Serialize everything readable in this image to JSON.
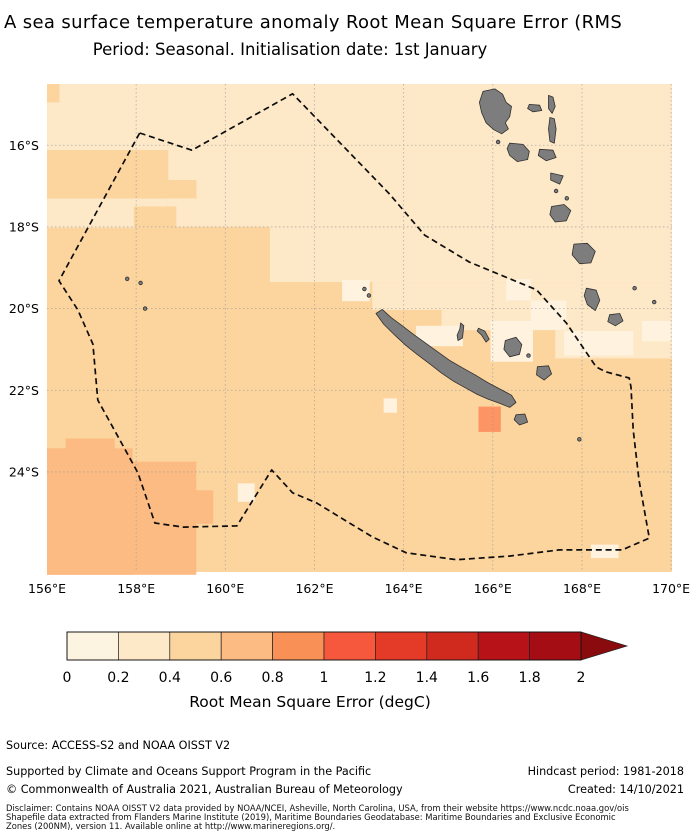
{
  "title": {
    "line1": "A sea surface temperature anomaly Root Mean Square Error (RMS",
    "line2": "Period: Seasonal. Initialisation date: 1st January"
  },
  "footer": {
    "source_line": "Source: ACCESS-S2 and NOAA OISST V2",
    "supported_line": "Supported by Climate and Oceans Support Program in the Pacific",
    "hindcast_line": "Hindcast period: 1981-2018",
    "copyright_line": "© Commonwealth of Australia 2021, Australian Bureau of Meteorology",
    "created_line": "Created: 14/10/2021",
    "disclaimer_lines": [
      "Disclaimer: Contains NOAA OISST V2 data provided by NOAA/NCEI, Asheville, North Carolina, USA, from their website https://www.ncdc.noaa.gov/ois",
      "Shapefile data extracted from Flanders Marine Institute (2019), Maritime Boundaries Geodatabase: Maritime Boundaries and Exclusive Economic",
      "Zones (200NM), version 11. Available online at http://www.marineregions.org/."
    ]
  },
  "chart_data": {
    "type": "heatmap",
    "title": "A sea surface temperature anomaly Root Mean Square Error (RMS",
    "subtitle": "Period: Seasonal. Initialisation date: 1st January",
    "region": "New Caledonia EEZ and surrounding Coral Sea / Vanuatu",
    "lon_range": [
      156.0,
      170.02
    ],
    "lat_range_south": [
      14.5,
      26.45
    ],
    "grid_lons": [
      158,
      160,
      162,
      164,
      166,
      168,
      170
    ],
    "grid_lats": [
      16,
      18,
      20,
      22,
      24
    ],
    "lon_tick_labels": [
      "156°E",
      "158°E",
      "160°E",
      "162°E",
      "164°E",
      "166°E",
      "168°E",
      "170°E"
    ],
    "lat_tick_labels": [
      "16°S",
      "18°S",
      "20°S",
      "22°S",
      "24°S"
    ],
    "colorbar": {
      "label": "Root Mean Square Error (degC)",
      "tick_labels": [
        "0",
        "0.2",
        "0.4",
        "0.6",
        "0.8",
        "1",
        "1.2",
        "1.4",
        "1.6",
        "1.8",
        "2"
      ],
      "range": [
        0,
        2
      ],
      "extend": "max",
      "segment_colors": [
        "#fdf3e1",
        "#fde8c8",
        "#fcd49e",
        "#fbbb83",
        "#f99157",
        "#f6583e",
        "#e43a28",
        "#cf2a1d",
        "#b71217",
        "#a30d13"
      ],
      "arrow_color": "#8a0b0e"
    },
    "band_values_degC": [
      "0-0.2",
      "0.2-0.4",
      "0.4-0.6",
      "0.6-0.8",
      "0.8-1.0"
    ],
    "band_colors": [
      "#fff3e0",
      "#fde8c8",
      "#fcd49e",
      "#fbbb83",
      "#fc9464"
    ],
    "base_band": 2,
    "patches": [
      {
        "lon": 156.0,
        "lat": 14.5,
        "w": 14.02,
        "h": 1.62,
        "band": 1
      },
      {
        "lon": 158.7,
        "lat": 16.12,
        "w": 11.32,
        "h": 1.88,
        "band": 1
      },
      {
        "lon": 156.0,
        "lat": 17.3,
        "w": 2.7,
        "h": 0.72,
        "band": 1
      },
      {
        "lon": 161.0,
        "lat": 18.0,
        "w": 9.02,
        "h": 1.35,
        "band": 1
      },
      {
        "lon": 163.3,
        "lat": 19.35,
        "w": 6.72,
        "h": 0.68,
        "band": 1
      },
      {
        "lon": 164.85,
        "lat": 20.03,
        "w": 5.17,
        "h": 0.5,
        "band": 1
      },
      {
        "lon": 167.4,
        "lat": 20.5,
        "w": 2.62,
        "h": 0.72,
        "band": 1
      },
      {
        "lon": 156.0,
        "lat": 14.5,
        "w": 0.28,
        "h": 0.45,
        "band": 2
      },
      {
        "lon": 156.0,
        "lat": 16.12,
        "w": 2.72,
        "h": 1.18,
        "band": 2
      },
      {
        "lon": 158.7,
        "lat": 16.85,
        "w": 0.65,
        "h": 0.45,
        "band": 2
      },
      {
        "lon": 157.95,
        "lat": 17.5,
        "w": 0.95,
        "h": 0.52,
        "band": 2
      },
      {
        "lon": 162.62,
        "lat": 19.3,
        "w": 0.62,
        "h": 0.52,
        "band": 0
      },
      {
        "lon": 166.3,
        "lat": 19.28,
        "w": 0.55,
        "h": 0.52,
        "band": 0
      },
      {
        "lon": 164.28,
        "lat": 20.42,
        "w": 1.05,
        "h": 0.5,
        "band": 0
      },
      {
        "lon": 165.95,
        "lat": 20.3,
        "w": 0.95,
        "h": 1.0,
        "band": 0
      },
      {
        "lon": 166.85,
        "lat": 19.8,
        "w": 0.8,
        "h": 0.72,
        "band": 0
      },
      {
        "lon": 167.6,
        "lat": 20.55,
        "w": 1.55,
        "h": 0.6,
        "band": 0
      },
      {
        "lon": 169.35,
        "lat": 20.3,
        "w": 0.65,
        "h": 0.5,
        "band": 0
      },
      {
        "lon": 168.2,
        "lat": 25.78,
        "w": 0.62,
        "h": 0.33,
        "band": 0
      },
      {
        "lon": 160.28,
        "lat": 24.28,
        "w": 0.38,
        "h": 0.45,
        "band": 0
      },
      {
        "lon": 163.55,
        "lat": 22.2,
        "w": 0.3,
        "h": 0.35,
        "band": 0
      },
      {
        "lon": 156.0,
        "lat": 23.42,
        "w": 1.92,
        "h": 3.1,
        "band": 3
      },
      {
        "lon": 157.9,
        "lat": 23.75,
        "w": 1.45,
        "h": 2.77,
        "band": 3
      },
      {
        "lon": 159.33,
        "lat": 24.45,
        "w": 0.4,
        "h": 0.82,
        "band": 3
      },
      {
        "lon": 156.42,
        "lat": 23.18,
        "w": 1.1,
        "h": 0.3,
        "band": 3
      },
      {
        "lon": 165.68,
        "lat": 22.4,
        "w": 0.5,
        "h": 0.62,
        "band": 4
      }
    ],
    "eez_boundary": [
      [
        158.08,
        15.7
      ],
      [
        159.25,
        16.12
      ],
      [
        161.51,
        14.74
      ],
      [
        163.68,
        17.19
      ],
      [
        164.47,
        18.2
      ],
      [
        165.47,
        18.86
      ],
      [
        166.98,
        19.54
      ],
      [
        167.65,
        20.35
      ],
      [
        168.32,
        21.43
      ],
      [
        168.54,
        21.55
      ],
      [
        169.06,
        21.7
      ],
      [
        169.1,
        21.92
      ],
      [
        169.15,
        22.97
      ],
      [
        169.28,
        24.2
      ],
      [
        169.51,
        25.62
      ],
      [
        168.9,
        25.91
      ],
      [
        167.49,
        25.91
      ],
      [
        166.37,
        26.06
      ],
      [
        165.18,
        26.15
      ],
      [
        164.06,
        25.98
      ],
      [
        163.3,
        25.59
      ],
      [
        162.56,
        25.1
      ],
      [
        162.05,
        24.76
      ],
      [
        161.51,
        24.51
      ],
      [
        161.04,
        23.95
      ],
      [
        160.26,
        25.32
      ],
      [
        159.05,
        25.35
      ],
      [
        158.42,
        25.25
      ],
      [
        158.04,
        24.02
      ],
      [
        157.57,
        23.09
      ],
      [
        157.14,
        22.24
      ],
      [
        157.03,
        20.87
      ],
      [
        156.69,
        20.03
      ],
      [
        156.27,
        19.32
      ]
    ],
    "land_color": "#7d7d7d",
    "land_edge_color": "#2f2f2f",
    "islands": {
      "grande-terre": [
        [
          163.38,
          20.12
        ],
        [
          163.52,
          20.02
        ],
        [
          163.72,
          20.22
        ],
        [
          163.97,
          20.42
        ],
        [
          164.22,
          20.63
        ],
        [
          164.5,
          20.85
        ],
        [
          164.78,
          21.07
        ],
        [
          165.05,
          21.28
        ],
        [
          165.32,
          21.45
        ],
        [
          165.6,
          21.62
        ],
        [
          165.9,
          21.82
        ],
        [
          166.18,
          21.98
        ],
        [
          166.42,
          22.12
        ],
        [
          166.52,
          22.3
        ],
        [
          166.38,
          22.42
        ],
        [
          166.15,
          22.32
        ],
        [
          165.9,
          22.22
        ],
        [
          165.65,
          22.1
        ],
        [
          165.4,
          21.95
        ],
        [
          165.12,
          21.78
        ],
        [
          164.85,
          21.58
        ],
        [
          164.58,
          21.35
        ],
        [
          164.3,
          21.12
        ],
        [
          164.05,
          20.9
        ],
        [
          163.8,
          20.65
        ],
        [
          163.55,
          20.38
        ]
      ],
      "espiritu-santo": [
        [
          165.78,
          14.68
        ],
        [
          166.05,
          14.62
        ],
        [
          166.22,
          14.75
        ],
        [
          166.3,
          14.95
        ],
        [
          166.42,
          15.05
        ],
        [
          166.38,
          15.3
        ],
        [
          166.28,
          15.45
        ],
        [
          166.35,
          15.6
        ],
        [
          166.2,
          15.72
        ],
        [
          166.02,
          15.62
        ],
        [
          165.85,
          15.45
        ],
        [
          165.75,
          15.2
        ],
        [
          165.7,
          14.95
        ]
      ],
      "malakula": [
        [
          166.38,
          15.95
        ],
        [
          166.68,
          15.98
        ],
        [
          166.82,
          16.15
        ],
        [
          166.78,
          16.35
        ],
        [
          166.55,
          16.4
        ],
        [
          166.38,
          16.25
        ],
        [
          166.32,
          16.08
        ]
      ],
      "maewo": [
        [
          167.25,
          14.78
        ],
        [
          167.35,
          14.82
        ],
        [
          167.4,
          15.05
        ],
        [
          167.33,
          15.22
        ],
        [
          167.25,
          15.1
        ]
      ],
      "pentecost": [
        [
          167.28,
          15.32
        ],
        [
          167.38,
          15.35
        ],
        [
          167.42,
          15.6
        ],
        [
          167.38,
          15.95
        ],
        [
          167.28,
          15.9
        ],
        [
          167.25,
          15.6
        ]
      ],
      "ambae": [
        [
          166.82,
          15.0
        ],
        [
          167.05,
          15.02
        ],
        [
          167.1,
          15.15
        ],
        [
          166.9,
          15.18
        ],
        [
          166.78,
          15.1
        ]
      ],
      "ambrym": [
        [
          167.05,
          16.1
        ],
        [
          167.35,
          16.12
        ],
        [
          167.42,
          16.3
        ],
        [
          167.2,
          16.38
        ],
        [
          167.02,
          16.25
        ]
      ],
      "epi": [
        [
          167.3,
          16.68
        ],
        [
          167.58,
          16.75
        ],
        [
          167.5,
          16.95
        ],
        [
          167.3,
          16.85
        ]
      ],
      "efate": [
        [
          167.32,
          17.5
        ],
        [
          167.6,
          17.45
        ],
        [
          167.75,
          17.6
        ],
        [
          167.65,
          17.85
        ],
        [
          167.4,
          17.88
        ],
        [
          167.28,
          17.7
        ]
      ],
      "erromango": [
        [
          167.82,
          18.42
        ],
        [
          168.12,
          18.4
        ],
        [
          168.3,
          18.6
        ],
        [
          168.2,
          18.88
        ],
        [
          167.95,
          18.9
        ],
        [
          167.78,
          18.68
        ]
      ],
      "tanna": [
        [
          168.1,
          19.5
        ],
        [
          168.32,
          19.55
        ],
        [
          168.4,
          19.8
        ],
        [
          168.3,
          20.05
        ],
        [
          168.12,
          19.9
        ],
        [
          168.05,
          19.68
        ]
      ],
      "aneityum": [
        [
          168.62,
          20.15
        ],
        [
          168.85,
          20.12
        ],
        [
          168.92,
          20.3
        ],
        [
          168.75,
          20.42
        ],
        [
          168.58,
          20.32
        ]
      ],
      "ouvea": [
        [
          165.68,
          20.48
        ],
        [
          165.82,
          20.55
        ],
        [
          165.92,
          20.75
        ],
        [
          165.85,
          20.82
        ],
        [
          165.75,
          20.65
        ],
        [
          165.65,
          20.55
        ]
      ],
      "lifou": [
        [
          166.28,
          20.78
        ],
        [
          166.52,
          20.7
        ],
        [
          166.65,
          20.88
        ],
        [
          166.6,
          21.12
        ],
        [
          166.38,
          21.18
        ],
        [
          166.25,
          21.0
        ]
      ],
      "mare": [
        [
          167.0,
          21.42
        ],
        [
          167.25,
          21.4
        ],
        [
          167.32,
          21.6
        ],
        [
          167.15,
          21.75
        ],
        [
          166.98,
          21.62
        ]
      ],
      "isle-of-pines": [
        [
          166.52,
          22.6
        ],
        [
          166.72,
          22.58
        ],
        [
          166.78,
          22.78
        ],
        [
          166.6,
          22.85
        ],
        [
          166.48,
          22.72
        ]
      ],
      "reef-arc": [
        [
          165.28,
          20.35
        ],
        [
          165.35,
          20.42
        ],
        [
          165.32,
          20.72
        ],
        [
          165.22,
          20.78
        ],
        [
          165.2,
          20.65
        ],
        [
          165.26,
          20.5
        ]
      ]
    },
    "island_dots": [
      [
        163.12,
        19.52
      ],
      [
        163.22,
        19.68
      ],
      [
        166.12,
        15.92
      ],
      [
        167.42,
        17.12
      ],
      [
        167.66,
        17.3
      ],
      [
        166.8,
        21.15
      ],
      [
        169.18,
        19.5
      ],
      [
        169.62,
        19.84
      ],
      [
        167.94,
        23.2
      ],
      [
        157.8,
        19.27
      ],
      [
        158.1,
        19.37
      ],
      [
        158.2,
        20.0
      ]
    ]
  }
}
